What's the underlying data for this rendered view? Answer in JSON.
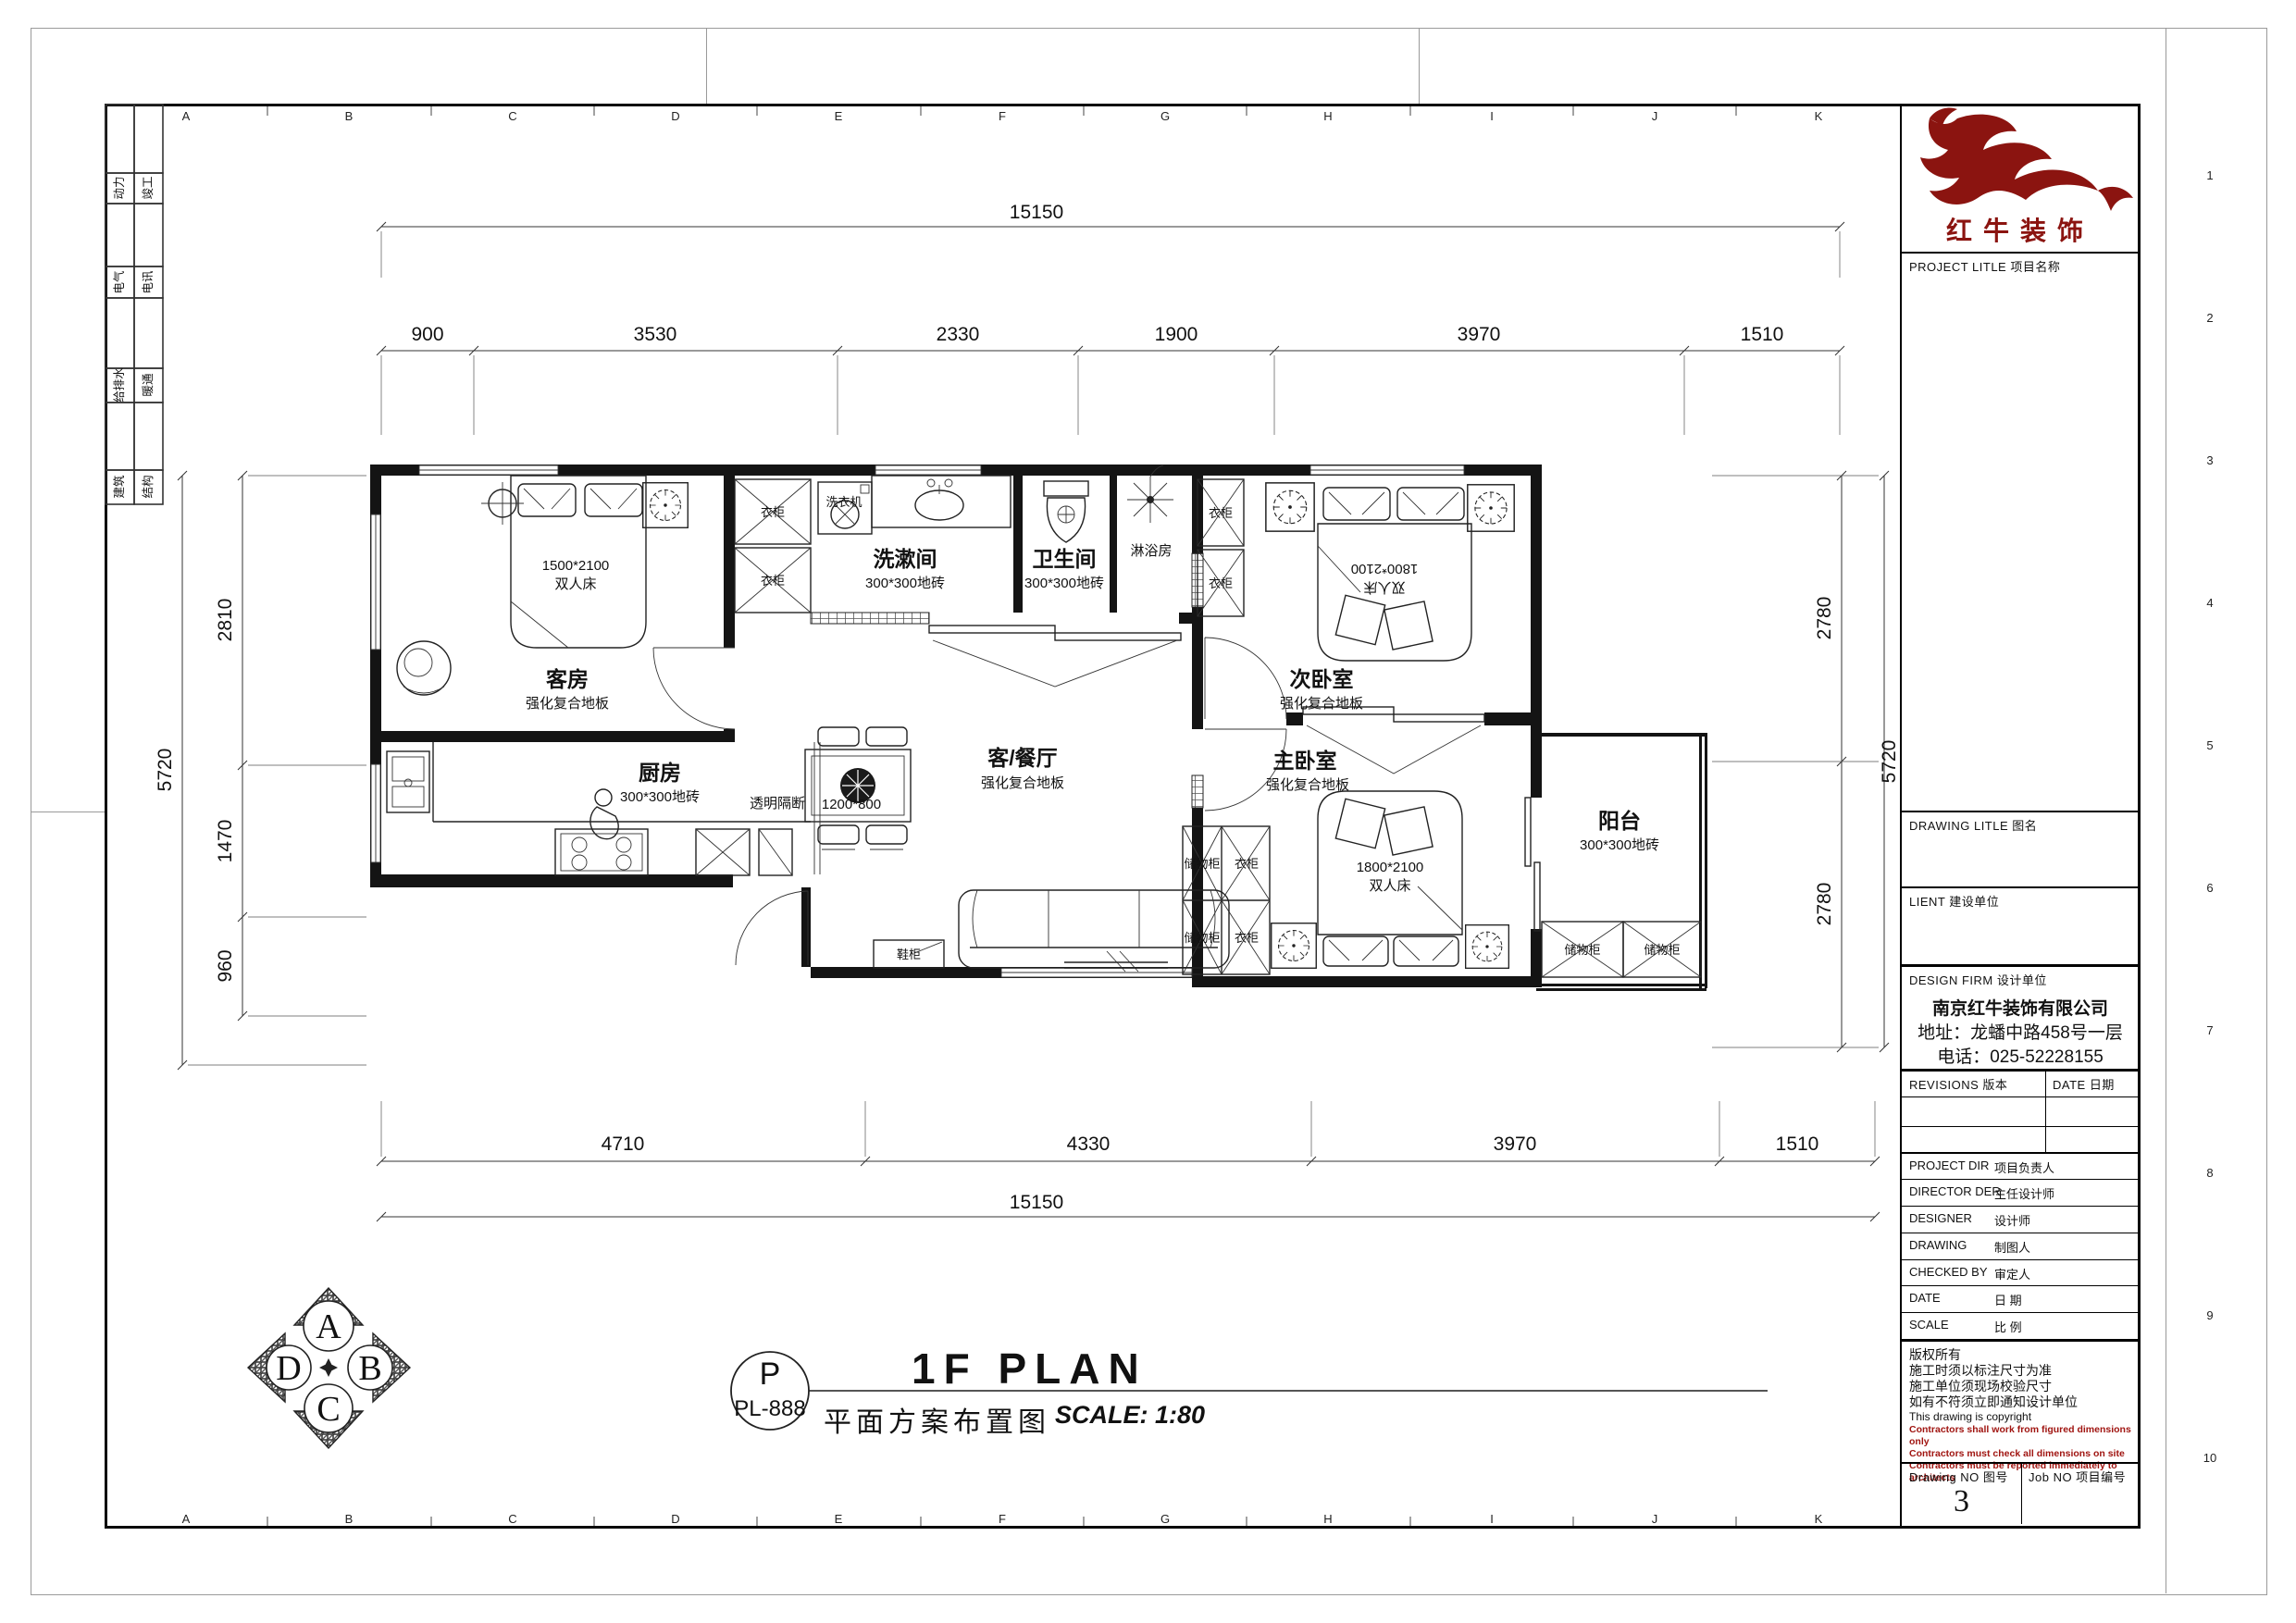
{
  "title_block": {
    "logo_name": "红牛装饰",
    "project_label": "PROJECT LITLE  项目名称",
    "drawing_title_label": "DRAWING LITLE  图名",
    "client_label": "LIENT  建设单位",
    "design_firm_label": "DESIGN FIRM  设计单位",
    "firm_name": "南京红牛装饰有限公司",
    "firm_address": "地址：龙蟠中路458号一层",
    "firm_phone": "电话：025-52228155",
    "revisions_label": "REVISIONS  版本",
    "revisions_date_label": "DATE  日期",
    "rows": [
      {
        "en": "PROJECT DIR",
        "cn": "项目负责人"
      },
      {
        "en": "DIRECTOR DER",
        "cn": "主任设计师"
      },
      {
        "en": "DESIGNER",
        "cn": "设计师"
      },
      {
        "en": "DRAWING",
        "cn": "制图人"
      },
      {
        "en": "CHECKED BY",
        "cn": "审定人"
      },
      {
        "en": "DATE",
        "cn": "日  期"
      },
      {
        "en": "SCALE",
        "cn": "比  例"
      }
    ],
    "copyright": [
      "版权所有",
      "施工时须以标注尺寸为准",
      "施工单位须现场校验尺寸",
      "如有不符须立即通知设计单位",
      "This drawing is copyright"
    ],
    "copyright_red": [
      "Contractors shall work from figured dimensions only",
      "Contractors must check all dimensions on site",
      "Contractors must be reported immediately to architects"
    ],
    "drawing_no_label": "Drawing NO  图号",
    "drawing_no": "3",
    "job_no_label": "Job NO  项目编号"
  },
  "footer": {
    "stamp_letter": "P",
    "stamp_code": "PL-888",
    "title_cn": "平面方案布置图",
    "title_en": "1F PLAN",
    "scale_text": "SCALE: 1:80"
  },
  "compass": {
    "top": "A",
    "right": "B",
    "bottom": "C",
    "left": "D"
  },
  "ladder": {
    "rows": [
      [
        "动力",
        "竣工"
      ],
      [
        "电气",
        "电讯"
      ],
      [
        "给排水",
        "暖通"
      ],
      [
        "建筑",
        "结构"
      ]
    ]
  },
  "rulers": {
    "letters": [
      "A",
      "B",
      "C",
      "D",
      "E",
      "F",
      "G",
      "H",
      "I",
      "J",
      "K"
    ],
    "numbers": [
      "1",
      "2",
      "3",
      "4",
      "5",
      "6",
      "7",
      "8",
      "9",
      "10"
    ]
  },
  "plan": {
    "rooms": {
      "guest": {
        "name": "客房",
        "floor": "强化复合地板"
      },
      "wash": {
        "name": "洗漱间",
        "floor": "300*300地砖"
      },
      "wc": {
        "name": "卫生间",
        "floor": "300*300地砖"
      },
      "shower": {
        "name": "淋浴房"
      },
      "second": {
        "name": "次卧室",
        "floor": "强化复合地板"
      },
      "living": {
        "name": "客/餐厅",
        "floor": "强化复合地板"
      },
      "kitchen": {
        "name": "厨房",
        "floor": "300*300地砖"
      },
      "master": {
        "name": "主卧室",
        "floor": "强化复合地板"
      },
      "balcony": {
        "name": "阳台",
        "floor": "300*300地砖"
      }
    },
    "furniture": {
      "washer": "洗衣机",
      "wardrobe": "衣柜",
      "storage": "储物柜",
      "shoe_cabinet": "鞋柜",
      "partition": "透明隔断",
      "table_size": "1200*800",
      "double_bed": "双人床",
      "guest_bed_size": "1500*2100",
      "second_bed_size": "1800*2100",
      "master_bed_size": "1800*2100"
    },
    "dims": {
      "total": "15150",
      "top": [
        "900",
        "3530",
        "2330",
        "1900",
        "3970",
        "1510"
      ],
      "bottom": [
        "4710",
        "4330",
        "3970",
        "1510"
      ],
      "left": [
        "2810",
        "1470",
        "960"
      ],
      "left_total": "5720",
      "right": [
        "2780",
        "2780"
      ],
      "right_total": "5720"
    }
  }
}
